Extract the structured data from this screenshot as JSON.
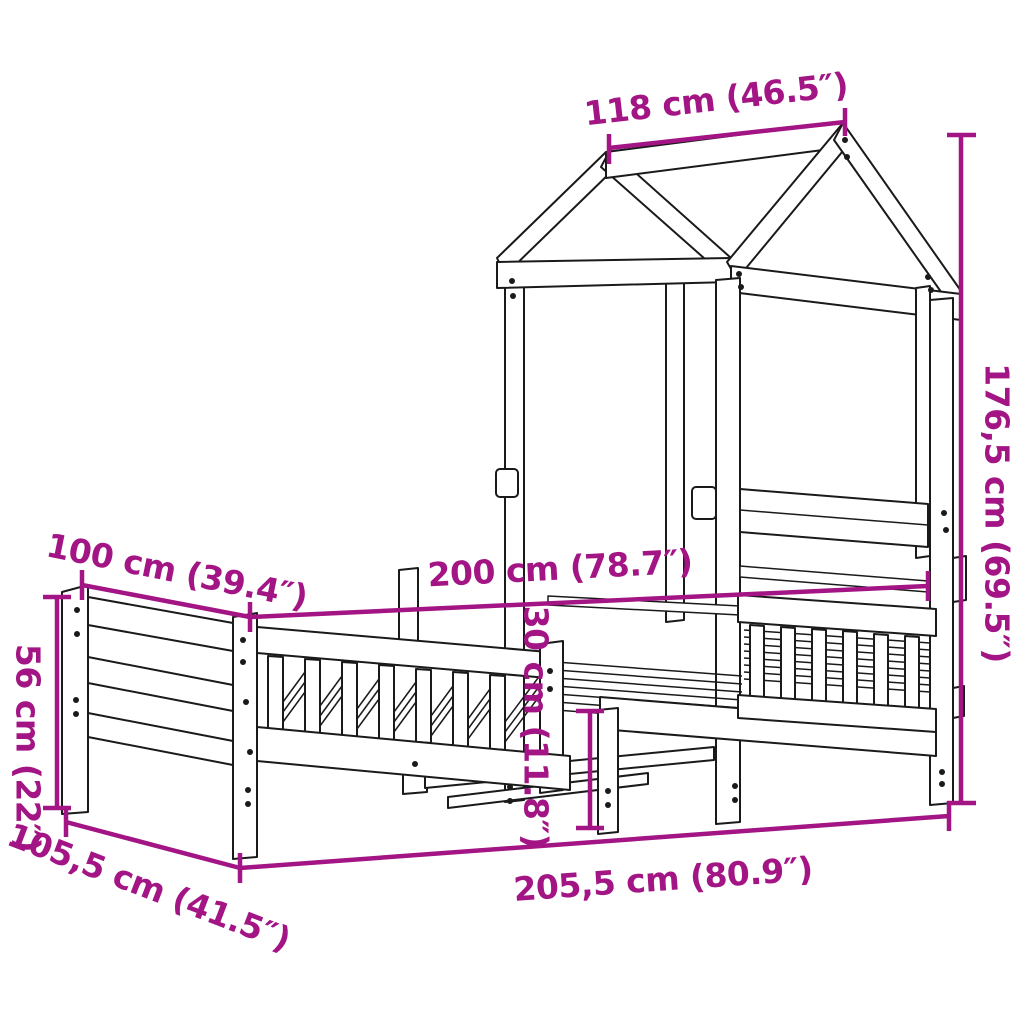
{
  "meta": {
    "product": "Bed frame with house-shaped roof canopy — dimension diagram",
    "background_color": "#ffffff",
    "line_art_color": "#1a1a1a",
    "accent_color": "#A31484"
  },
  "dimensions": {
    "roof_top": {
      "label": "118 cm (46.5″)",
      "cm": "118",
      "inches": "46.5"
    },
    "total_height": {
      "label": "176,5 cm (69.5″)",
      "cm": "176,5",
      "inches": "69.5"
    },
    "bed_width": {
      "label": "100 cm (39.4″)",
      "cm": "100",
      "inches": "39.4"
    },
    "bed_length": {
      "label": "200 cm (78.7″)",
      "cm": "200",
      "inches": "78.7"
    },
    "frame_height": {
      "label": "56 cm (22″)",
      "cm": "56",
      "inches": "22"
    },
    "clearance": {
      "label": "30 cm (11.8″)",
      "cm": "30",
      "inches": "11.8"
    },
    "total_length": {
      "label": "205,5 cm (80.9″)",
      "cm": "205,5",
      "inches": "80.9"
    },
    "total_width": {
      "label": "105,5 cm (41.5″)",
      "cm": "105,5",
      "inches": "41.5"
    }
  }
}
